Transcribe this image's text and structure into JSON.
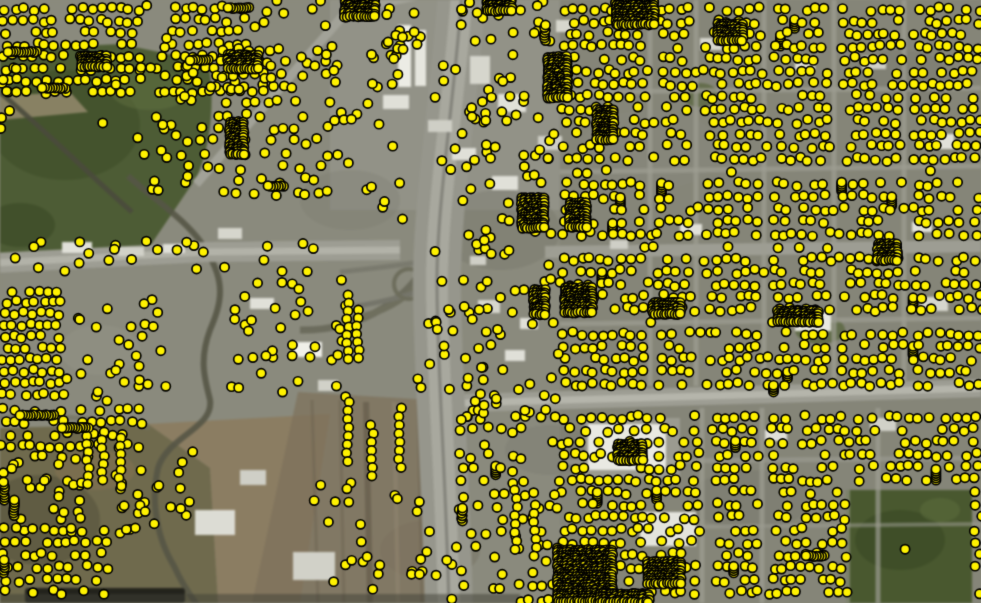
{
  "map": {
    "kind": "satellite-aerial-basemap-with-point-marker-overlay",
    "description": "Aerial imagery of an urban area with a freeway interchange; dense yellow GIS point markers (address/parcel points) overlaid across residential blocks",
    "visible_text": [],
    "palette": {
      "ground": "#8a8a7d",
      "vegetation": "#4d5c35",
      "dirt": "#8b7c61",
      "road": "#9d9d93",
      "freeway": "#96968c",
      "building": "#e0e0d8",
      "water_canal": "#555546",
      "marker_fill": "#fff200",
      "marker_stroke": "#000000"
    }
  },
  "marker_layer": {
    "style": {
      "radius": 4.6,
      "stroke_width": 1.7,
      "fill": "#fff200",
      "stroke": "#000000"
    },
    "seed": 1337,
    "zones": [
      {
        "x": 560,
        "y": 0,
        "w": 421,
        "h": 386,
        "rowGap": 12.5,
        "dotGap": 9.6,
        "skip": 0.2,
        "jitter": 2.4,
        "blackRate": 0.014,
        "vlanes": [
          [
            648,
            10
          ],
          [
            694,
            9
          ],
          [
            762,
            10
          ],
          [
            832,
            9
          ],
          [
            902,
            9
          ]
        ],
        "hlanes": [
          [
            88,
            8
          ],
          [
            166,
            7
          ],
          [
            244,
            15
          ],
          [
            320,
            7
          ]
        ],
        "holes": []
      },
      {
        "x": 560,
        "y": 408,
        "w": 421,
        "h": 195,
        "rowGap": 12.5,
        "dotGap": 9.6,
        "skip": 0.24,
        "jitter": 2.4,
        "blackRate": 0.012,
        "vlanes": [
          [
            700,
            10
          ],
          [
            760,
            9
          ],
          [
            876,
            10
          ]
        ],
        "hlanes": [
          [
            458,
            8
          ]
        ],
        "holes": [
          [
            846,
            490,
            125,
            113
          ],
          [
            556,
            548,
            62,
            55
          ]
        ]
      },
      {
        "x": 0,
        "y": 0,
        "w": 140,
        "h": 100,
        "rowGap": 12,
        "dotGap": 9.6,
        "skip": 0.14,
        "jitter": 2.2,
        "blackRate": 0.012,
        "vlanes": [],
        "hlanes": [],
        "holes": []
      },
      {
        "x": 168,
        "y": 0,
        "w": 80,
        "h": 94,
        "rowGap": 12,
        "dotGap": 9.6,
        "skip": 0.17,
        "jitter": 2.2,
        "blackRate": 0.01,
        "vlanes": [],
        "hlanes": [],
        "holes": []
      },
      {
        "x": 214,
        "y": 40,
        "w": 72,
        "h": 54,
        "rowGap": 12,
        "dotGap": 9.6,
        "skip": 0.2,
        "jitter": 2.0,
        "blackRate": 0,
        "vlanes": [],
        "hlanes": [],
        "holes": []
      },
      {
        "x": 0,
        "y": 286,
        "w": 64,
        "h": 116,
        "rowGap": 11.5,
        "dotGap": 9.0,
        "skip": 0.1,
        "jitter": 1.8,
        "blackRate": 0.015,
        "vlanes": [],
        "hlanes": [],
        "holes": []
      },
      {
        "x": 0,
        "y": 398,
        "w": 142,
        "h": 54,
        "rowGap": 12,
        "dotGap": 9.6,
        "skip": 0.16,
        "jitter": 2.0,
        "blackRate": 0.02,
        "vlanes": [],
        "hlanes": [],
        "holes": []
      },
      {
        "x": 0,
        "y": 528,
        "w": 112,
        "h": 75,
        "rowGap": 12.5,
        "dotGap": 10,
        "skip": 0.26,
        "jitter": 2.4,
        "blackRate": 0,
        "vlanes": [],
        "hlanes": [],
        "holes": []
      },
      {
        "x": 180,
        "y": 58,
        "w": 165,
        "h": 145,
        "rowGap": 13,
        "dotGap": 10.5,
        "skip": 0.55,
        "jitter": 3.0,
        "blackRate": 0.01,
        "vlanes": [],
        "hlanes": [],
        "holes": []
      },
      {
        "x": 455,
        "y": 415,
        "w": 105,
        "h": 188,
        "rowGap": 13,
        "dotGap": 10,
        "skip": 0.5,
        "jitter": 3.0,
        "blackRate": 0.02,
        "vlanes": [],
        "hlanes": [],
        "holes": []
      }
    ],
    "clusters": [
      {
        "type": "scatter",
        "x": 135,
        "y": 95,
        "w": 55,
        "h": 110,
        "count": 12
      },
      {
        "type": "scatter",
        "x": 100,
        "y": 58,
        "w": 100,
        "h": 75,
        "count": 6
      },
      {
        "type": "scatter",
        "x": 0,
        "y": 65,
        "w": 18,
        "h": 72,
        "count": 7
      },
      {
        "type": "scatter",
        "x": 0,
        "y": 238,
        "w": 345,
        "h": 34,
        "count": 26
      },
      {
        "type": "scatter",
        "x": 66,
        "y": 292,
        "w": 100,
        "h": 112,
        "count": 30
      },
      {
        "type": "scatter",
        "x": 230,
        "y": 278,
        "w": 118,
        "h": 125,
        "count": 38
      },
      {
        "type": "scatter",
        "x": 248,
        "y": 0,
        "w": 85,
        "h": 58,
        "count": 12
      },
      {
        "type": "scatter",
        "x": 140,
        "y": 0,
        "w": 30,
        "h": 95,
        "count": 10
      },
      {
        "type": "scatter",
        "x": 333,
        "y": 0,
        "w": 92,
        "h": 125,
        "count": 34
      },
      {
        "type": "scatter",
        "x": 335,
        "y": 128,
        "w": 68,
        "h": 112,
        "count": 8
      },
      {
        "type": "scatter",
        "x": 428,
        "y": 55,
        "w": 30,
        "h": 245,
        "count": 9
      },
      {
        "type": "scatter",
        "x": 460,
        "y": 0,
        "w": 100,
        "h": 205,
        "count": 62
      },
      {
        "type": "scatter",
        "x": 460,
        "y": 205,
        "w": 100,
        "h": 185,
        "count": 52
      },
      {
        "type": "scatter",
        "x": 398,
        "y": 298,
        "w": 58,
        "h": 95,
        "count": 13
      },
      {
        "type": "scatter",
        "x": 300,
        "y": 475,
        "w": 55,
        "h": 58,
        "count": 6
      },
      {
        "type": "scatter",
        "x": 330,
        "y": 495,
        "w": 125,
        "h": 108,
        "count": 26
      },
      {
        "type": "scatter",
        "x": 112,
        "y": 450,
        "w": 82,
        "h": 85,
        "count": 26
      },
      {
        "type": "scatter",
        "x": 0,
        "y": 452,
        "w": 90,
        "h": 78,
        "count": 30
      },
      {
        "type": "scatter",
        "x": 458,
        "y": 392,
        "w": 100,
        "h": 28,
        "count": 16
      },
      {
        "type": "scatter",
        "x": 900,
        "y": 548,
        "w": 12,
        "h": 12,
        "count": 1
      },
      {
        "type": "cols",
        "x": 348,
        "y": 295,
        "n": 9,
        "gap": 8
      },
      {
        "type": "cols",
        "x": 358,
        "y": 310,
        "n": 7,
        "gap": 8
      },
      {
        "type": "cols",
        "x": 348,
        "y": 402,
        "n": 8,
        "gap": 8.5
      },
      {
        "type": "cols",
        "x": 372,
        "y": 425,
        "n": 7,
        "gap": 8.5
      },
      {
        "type": "cols",
        "x": 400,
        "y": 408,
        "n": 8,
        "gap": 8.5
      },
      {
        "type": "cols",
        "x": 88,
        "y": 428,
        "n": 8,
        "gap": 8
      },
      {
        "type": "cols",
        "x": 103,
        "y": 432,
        "n": 7,
        "gap": 8
      },
      {
        "type": "cols",
        "x": 120,
        "y": 438,
        "n": 7,
        "gap": 8
      },
      {
        "type": "cols",
        "x": 516,
        "y": 490,
        "n": 8,
        "gap": 8.5
      },
      {
        "type": "cols",
        "x": 535,
        "y": 505,
        "n": 7,
        "gap": 8.5
      },
      {
        "type": "hstack",
        "x": 20,
        "y": 415,
        "n": 14
      },
      {
        "type": "hstack",
        "x": 62,
        "y": 428,
        "n": 10
      },
      {
        "type": "hstack",
        "x": 8,
        "y": 52,
        "n": 12
      },
      {
        "type": "hstack",
        "x": 42,
        "y": 88,
        "n": 10
      },
      {
        "type": "hstack",
        "x": 190,
        "y": 60,
        "n": 8
      },
      {
        "type": "hstack",
        "x": 228,
        "y": 8,
        "n": 9
      },
      {
        "type": "hstack",
        "x": 268,
        "y": 186,
        "n": 7
      },
      {
        "type": "hstack",
        "x": 806,
        "y": 556,
        "n": 8
      },
      {
        "type": "vstack",
        "x": 4,
        "y": 482,
        "n": 8
      },
      {
        "type": "vstack",
        "x": 14,
        "y": 500,
        "n": 7
      },
      {
        "type": "vstack",
        "x": 4,
        "y": 560,
        "n": 6
      },
      {
        "type": "vstack",
        "x": 462,
        "y": 508,
        "n": 6
      },
      {
        "type": "vstack",
        "x": 545,
        "y": 25,
        "n": 7
      }
    ],
    "black_blocks": [
      [
        616,
        0,
        38,
        26
      ],
      [
        718,
        24,
        26,
        18
      ],
      [
        487,
        0,
        26,
        13
      ],
      [
        548,
        57,
        20,
        42
      ],
      [
        597,
        110,
        17,
        30
      ],
      [
        522,
        198,
        22,
        30
      ],
      [
        570,
        203,
        17,
        26
      ],
      [
        565,
        288,
        28,
        26
      ],
      [
        534,
        290,
        13,
        26
      ],
      [
        653,
        303,
        28,
        12
      ],
      [
        778,
        311,
        42,
        12
      ],
      [
        878,
        244,
        20,
        17
      ],
      [
        618,
        444,
        26,
        18
      ],
      [
        558,
        550,
        56,
        53
      ],
      [
        600,
        594,
        50,
        9
      ],
      [
        648,
        562,
        34,
        22
      ],
      [
        228,
        55,
        30,
        14
      ],
      [
        230,
        122,
        14,
        34
      ],
      [
        82,
        56,
        26,
        13
      ],
      [
        345,
        0,
        30,
        18
      ]
    ]
  }
}
